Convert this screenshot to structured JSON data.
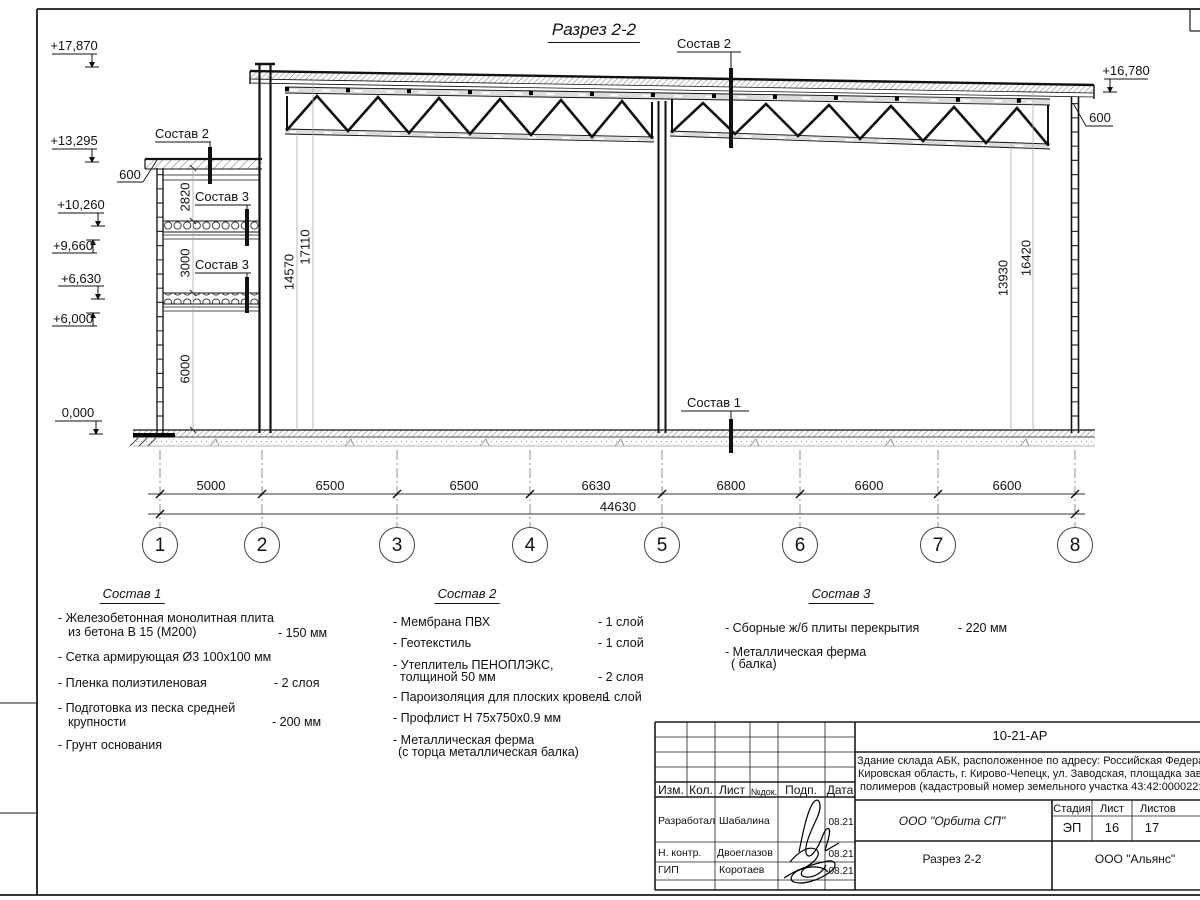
{
  "sheet": {
    "title": "Разрез 2-2",
    "elevations": {
      "e17870": "+17,870",
      "e13295": "+13,295",
      "e10260": "+10,260",
      "e9660": "+9,660",
      "e6630": "+6,630",
      "e6000": "+6,000",
      "e0": "0,000",
      "e16780": "+16,780"
    },
    "overhang_left": "600",
    "overhang_right": "600",
    "vdims": {
      "d2820": "2820",
      "d3000": "3000",
      "d6000": "6000",
      "d14570": "14570",
      "d17110": "17110",
      "d13930": "13930",
      "d16420": "16420"
    },
    "callouts": {
      "sostav1": "Состав 1",
      "sostav2": "Состав 2",
      "sostav3": "Состав 3"
    },
    "span_dims": [
      "5000",
      "6500",
      "6500",
      "6630",
      "6800",
      "6600",
      "6600"
    ],
    "total_dim": "44630",
    "axes": [
      "1",
      "2",
      "3",
      "4",
      "5",
      "6",
      "7",
      "8"
    ]
  },
  "legend": {
    "s1": {
      "title": "Состав 1",
      "i1l1": "- Железобетонная  монолитная плита",
      "i1l2": "из бетона В 15 (М200)",
      "i1v": "- 150 мм",
      "i2l1": "- Сетка армирующая Ø3 100х100 мм",
      "i3l1": "- Пленка полиэтиленовая",
      "i3v": "-  2 слоя",
      "i4l1": "- Подготовка из песка средней",
      "i4l2": "крупности",
      "i4v": "- 200 мм",
      "i5l1": "- Грунт основания"
    },
    "s2": {
      "title": "Состав 2",
      "i1l1": "- Мембрана ПВХ",
      "i1v": "- 1 слой",
      "i2l1": "- Геотекстиль",
      "i2v": "- 1 слой",
      "i3l1": "- Утеплитель ПЕНОПЛЭКС,",
      "i3l2": "толщиной 50 мм",
      "i3v": "- 2 слоя",
      "i4l1": "- Пароизоляция для плоских кровель",
      "i4v": "- 1 слой",
      "i5l1": "- Профлист Н 75х750х0.9 мм",
      "i6l1": "- Металлическая ферма",
      "i6l2": "(с торца металлическая балка)"
    },
    "s3": {
      "title": "Состав 3",
      "i1l1": "- Сборные ж/б плиты перекрытия",
      "i1v": "- 220 мм",
      "i2l1": "- Металлическая ферма",
      "i2l2": "( балка)"
    }
  },
  "titleblock": {
    "doc_number": "10-21-АР",
    "desc1": "Здание склада АБК, расположенное по адресу: Российская Федерация,",
    "desc2": "Кировская область, г. Кирово-Чепецк, ул. Заводская, площадка завода",
    "desc3": "полимеров (кадастровый номер земельного участка 43:42:000022:3",
    "col_izm": "Изм.",
    "col_kol": "Кол.",
    "col_list": "Лист",
    "col_ndok": "№док.",
    "col_podp": "Подп.",
    "col_data": "Дата",
    "row1_role": "Разработал",
    "row1_name": "Шабалина",
    "row1_date": "08.21",
    "row2_role": "Н. контр.",
    "row2_name": "Двоеглазов",
    "row2_date": "08.21",
    "row3_role": "ГИП",
    "row3_name": "Коротаев",
    "row3_date": "08.21",
    "company": "ООО \"Орбита СП\"",
    "stage_label": "Стадия",
    "sheet_label": "Лист",
    "sheets_label": "Листов",
    "stage": "ЭП",
    "sheet_no": "16",
    "sheets_total": "17",
    "drawing_name": "Разрез 2-2",
    "contractor": "ООО \"Альянс\""
  }
}
